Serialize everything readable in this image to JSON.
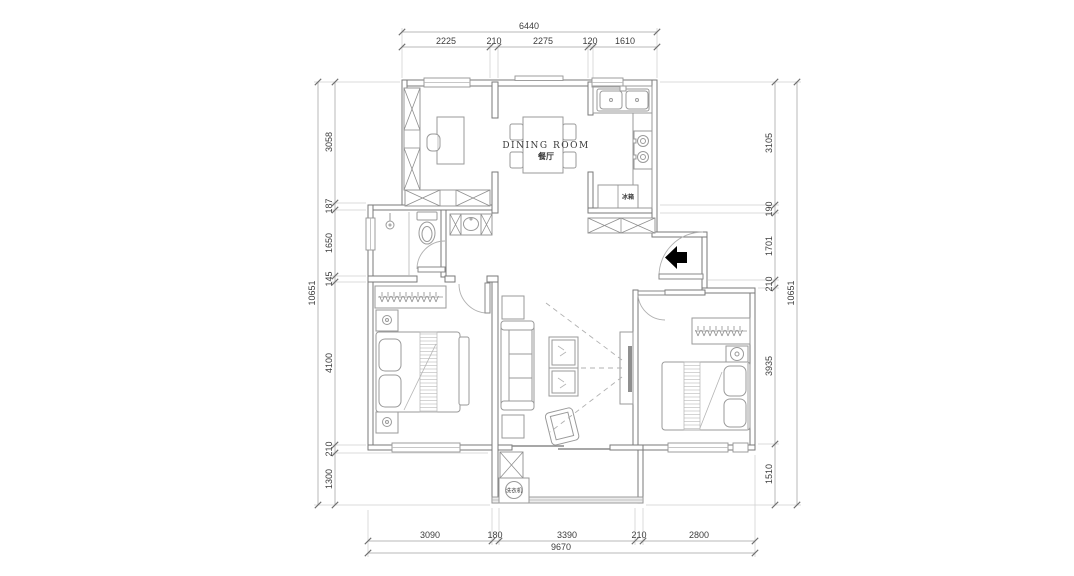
{
  "labels": {
    "dining_en": "DINING ROOM",
    "dining_zh": "餐厅",
    "fridge": "冰箱",
    "washer": "洗衣机"
  },
  "dimensions": {
    "top": {
      "total": "6440",
      "segments": [
        "2225",
        "210",
        "2275",
        "120",
        "1610"
      ]
    },
    "bottom": {
      "total": "9670",
      "segments": [
        "3090",
        "180",
        "3390",
        "210",
        "2800"
      ]
    },
    "left": {
      "total": "10651",
      "segments": [
        "3058",
        "187",
        "1650",
        "145",
        "4100",
        "210",
        "1300"
      ]
    },
    "right": {
      "total": "10651",
      "segments": [
        "3105",
        "190",
        "1701",
        "210",
        "3935",
        "1510"
      ]
    }
  },
  "colors": {
    "wall": "#7a7a7a",
    "furniture": "#9a9a9a",
    "dimension_line": "#b8b8b8",
    "text": "#3d3d3d",
    "entry_arrow": "#000000"
  }
}
